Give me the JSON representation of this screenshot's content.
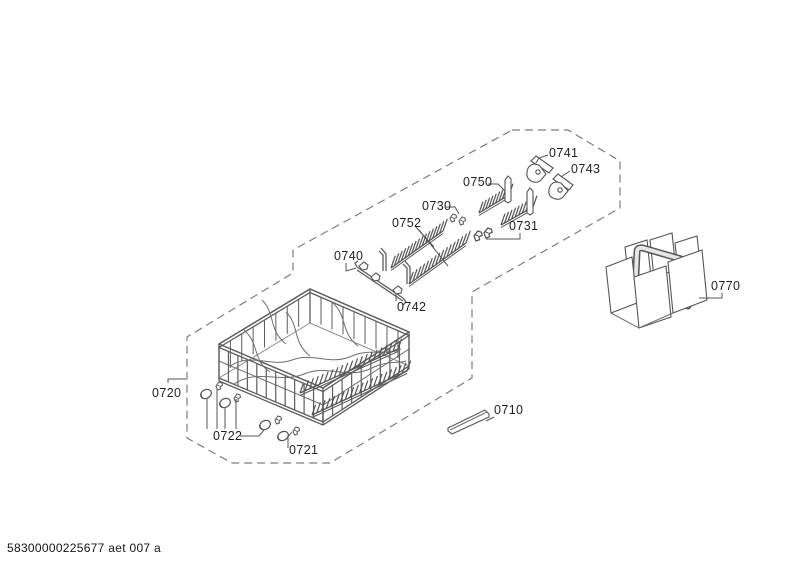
{
  "diagram": {
    "footer_code": "58300000225677 aet 007 a",
    "palette": {
      "line": "#5c5c5c",
      "dash_border": "#7d7d7d",
      "label_text": "#1f1f1f",
      "basket_fill": "#dedede"
    },
    "labels": {
      "0710": "0710",
      "0720": "0720",
      "0721": "0721",
      "0722": "0722",
      "0730": "0730",
      "0731": "0731",
      "0740": "0740",
      "0741": "0741",
      "0742": "0742",
      "0743": "0743",
      "0750": "0750",
      "0752": "0752",
      "0770": "0770"
    }
  }
}
